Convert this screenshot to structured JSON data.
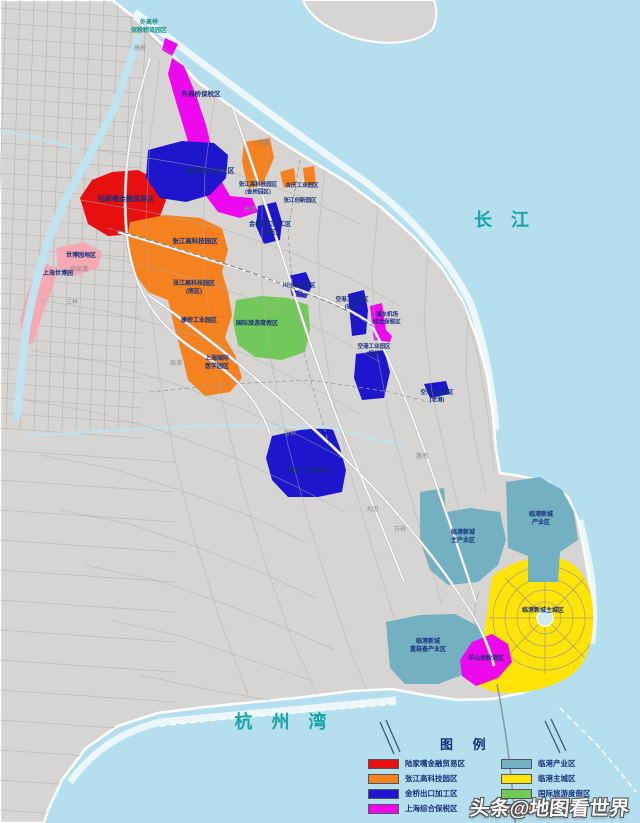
{
  "colors": {
    "water": "#b5dfee",
    "land": "#d6d5d3",
    "coast": "#ffffff",
    "river": "#bfe3f1",
    "road_minor": "#aeadaa",
    "road_casing": "#c2c1bf",
    "road_major": "#ffffff",
    "boundary": "#9a9a97",
    "zone_red": "#e80f10",
    "zone_orange": "#f5821f",
    "zone_blue": "#1d16cc",
    "zone_magenta": "#ee08ee",
    "zone_pink": "#f4a9b4",
    "zone_teal": "#72b0c2",
    "zone_yellow": "#ffe406",
    "zone_green": "#72c95a",
    "label_navy": "#16307a",
    "water_text": "#17a5a5",
    "town_text": "#8b8b88"
  },
  "water_labels": [
    {
      "id": "changjiang",
      "text": "长  江",
      "x": 505,
      "y": 226
    },
    {
      "id": "hangzhouwan",
      "text": "杭 州 湾",
      "x": 284,
      "y": 728
    }
  ],
  "zone_labels": [
    {
      "id": "waigaoqiao-logistics",
      "x": 149,
      "y": 24,
      "fs": 6,
      "cls": "teal-label",
      "lines": [
        "外高桥",
        "保税物流园区"
      ]
    },
    {
      "id": "waigaoqiao-ftz",
      "x": 201,
      "y": 96,
      "fs": 6.5,
      "lines": [
        "外高桥保税区"
      ]
    },
    {
      "id": "lujiazui",
      "x": 126,
      "y": 201,
      "fs": 7,
      "lines": [
        "陆家嘴金融贸易区"
      ]
    },
    {
      "id": "jinqiao",
      "x": 210,
      "y": 173,
      "fs": 7,
      "lines": [
        "金桥出口加工区"
      ]
    },
    {
      "id": "jinqiao-south",
      "x": 270,
      "y": 226,
      "fs": 6,
      "lines": [
        "金桥出口加工区",
        "(南区)"
      ]
    },
    {
      "id": "zhangjiang",
      "x": 195,
      "y": 243,
      "fs": 6.5,
      "lines": [
        "张江高科技园区"
      ]
    },
    {
      "id": "zhangjiang-south",
      "x": 194,
      "y": 285,
      "fs": 6,
      "lines": [
        "张江高科技园区",
        "(南区)"
      ]
    },
    {
      "id": "zhangjiang-jinqiao",
      "x": 258,
      "y": 186,
      "fs": 5.5,
      "lines": [
        "张江高科技园区",
        "(金桥园区)"
      ]
    },
    {
      "id": "heqing",
      "x": 302,
      "y": 187,
      "fs": 5.5,
      "lines": [
        "合庆工业园区"
      ]
    },
    {
      "id": "zhangjiang-innovation",
      "x": 300,
      "y": 202,
      "fs": 5.5,
      "lines": [
        "张江创新园区"
      ]
    },
    {
      "id": "kangqiao",
      "x": 199,
      "y": 322,
      "fs": 6,
      "lines": [
        "康桥工业园区"
      ]
    },
    {
      "id": "intl-medical",
      "x": 217,
      "y": 360,
      "fs": 6,
      "lines": [
        "上海国际",
        "医学园区"
      ]
    },
    {
      "id": "tourism-resort",
      "x": 257,
      "y": 325,
      "fs": 6,
      "lines": [
        "国际旅游度假区"
      ]
    },
    {
      "id": "chuansha-park",
      "x": 299,
      "y": 287,
      "fs": 5.5,
      "lines": [
        "川沙经济园区"
      ]
    },
    {
      "id": "konggang-jichang",
      "x": 352,
      "y": 301,
      "fs": 5.5,
      "lines": [
        "空港工业园区",
        "(机场)"
      ]
    },
    {
      "id": "pudong-airport-ftz",
      "x": 387,
      "y": 316,
      "fs": 5.5,
      "lines": [
        "浦东机场",
        "综合保税区"
      ]
    },
    {
      "id": "konggang-zhuqiao",
      "x": 374,
      "y": 348,
      "fs": 5.5,
      "lines": [
        "空港工业园区",
        "(祝桥)"
      ]
    },
    {
      "id": "konggang-laogang",
      "x": 437,
      "y": 394,
      "fs": 5.5,
      "lines": [
        "空港工业园区",
        "(老港)"
      ]
    },
    {
      "id": "nanhui-industrial",
      "x": 308,
      "y": 472,
      "fs": 6.5,
      "lines": [
        "南汇工业园区"
      ]
    },
    {
      "id": "lingang-industry",
      "x": 541,
      "y": 516,
      "fs": 6,
      "lines": [
        "临港新城",
        "产业区"
      ]
    },
    {
      "id": "lingang-main-industry",
      "x": 463,
      "y": 534,
      "fs": 6,
      "lines": [
        "临港新城",
        "主产业区"
      ]
    },
    {
      "id": "lingang-heavy",
      "x": 428,
      "y": 643,
      "fs": 6,
      "lines": [
        "临港新城",
        "重装备产业区"
      ]
    },
    {
      "id": "lingang-city",
      "x": 543,
      "y": 612,
      "fs": 6,
      "lines": [
        "临港新城主城区"
      ]
    },
    {
      "id": "yangshan",
      "x": 486,
      "y": 660,
      "fs": 6,
      "lines": [
        "洋山保税港区"
      ]
    },
    {
      "id": "expo-area",
      "x": 81,
      "y": 257,
      "fs": 6,
      "lines": [
        "世博园地区"
      ]
    },
    {
      "id": "expo-park",
      "x": 58,
      "y": 275,
      "fs": 6,
      "lines": [
        "上海世博园"
      ]
    }
  ],
  "towns": [
    {
      "text": "高桥",
      "x": 140,
      "y": 50
    },
    {
      "text": "曹路",
      "x": 264,
      "y": 145
    },
    {
      "text": "唐镇",
      "x": 250,
      "y": 211
    },
    {
      "text": "川沙",
      "x": 301,
      "y": 297
    },
    {
      "text": "周家渡",
      "x": 79,
      "y": 271
    },
    {
      "text": "三林",
      "x": 72,
      "y": 304
    },
    {
      "text": "周浦",
      "x": 176,
      "y": 365
    },
    {
      "text": "宣桥",
      "x": 290,
      "y": 435
    },
    {
      "text": "大团",
      "x": 372,
      "y": 511
    },
    {
      "text": "万祥",
      "x": 400,
      "y": 531
    },
    {
      "text": "惠南",
      "x": 422,
      "y": 458
    }
  ],
  "legend": {
    "title": "图 例",
    "col1": [
      {
        "color": "zone_red",
        "label": "陆家嘴金融贸易区"
      },
      {
        "color": "zone_orange",
        "label": "张江高科技园区"
      },
      {
        "color": "zone_blue",
        "label": "金桥出口加工区"
      },
      {
        "color": "zone_magenta",
        "label": "上海综合保税区"
      }
    ],
    "col2": [
      {
        "color": "zone_teal",
        "label": "临港产业区"
      },
      {
        "color": "zone_yellow",
        "label": "临港主城区"
      },
      {
        "color": "zone_green",
        "label": "国际旅游度假区"
      },
      {
        "color": "zone_pink",
        "label": "世博园区"
      }
    ]
  },
  "watermark": {
    "text": "头条@地图看世界"
  }
}
